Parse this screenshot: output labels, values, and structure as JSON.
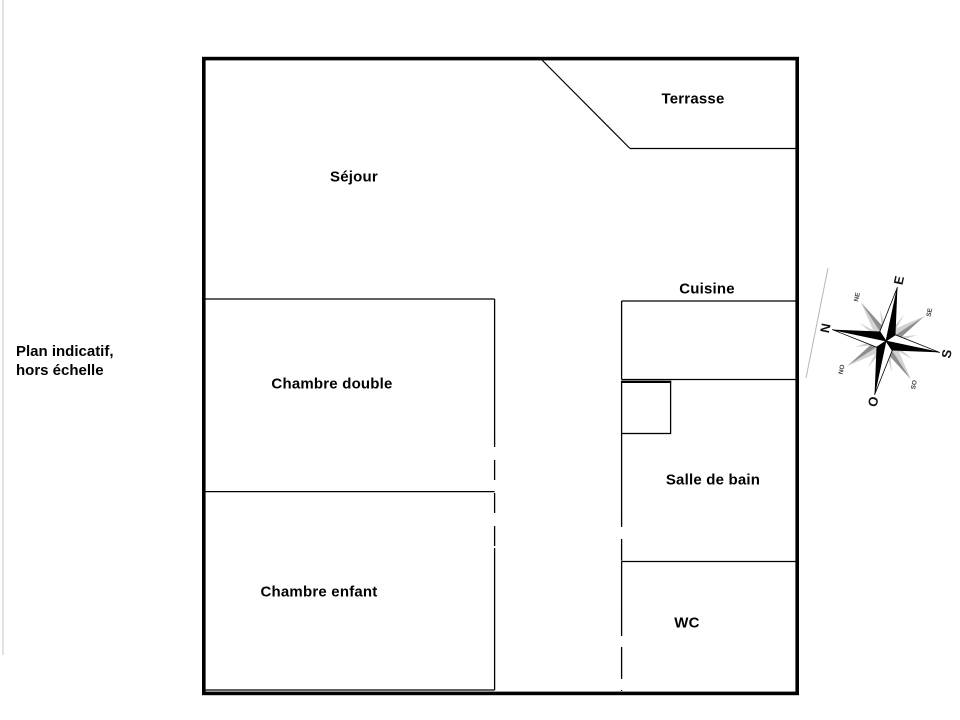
{
  "note": {
    "line1": "Plan indicatif,",
    "line2": "hors échelle"
  },
  "rooms": {
    "terrasse": "Terrasse",
    "sejour": "Séjour",
    "cuisine": "Cuisine",
    "chambre_double": "Chambre double",
    "chambre_enfant": "Chambre enfant",
    "salle_de_bain": "Salle de bain",
    "wc": "WC"
  },
  "compass": {
    "n": "N",
    "e": "E",
    "s": "S",
    "o": "O",
    "ne": "NE",
    "se": "SE",
    "so": "SO",
    "no": "NO"
  },
  "colors": {
    "wall": "#000000",
    "compass_dark": "#000000",
    "compass_gray": "#8e8e8e",
    "compass_light": "#cfcfcf"
  }
}
